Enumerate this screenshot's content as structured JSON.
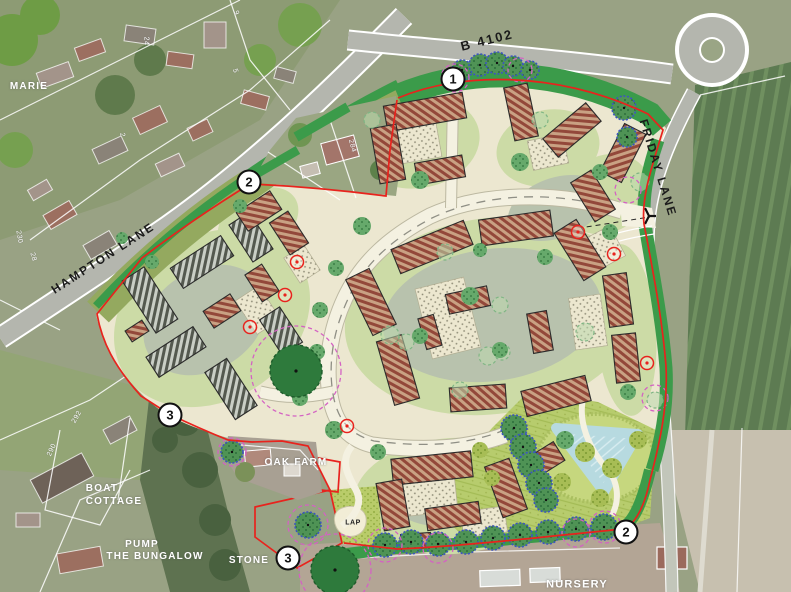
{
  "map_type": "residential development masterplan over aerial photograph",
  "colors": {
    "boundary_red": "#e8231d",
    "buffer_green": "#3b9b4a",
    "verge_olive": "#94a95f",
    "site_cream": "#ece7d0",
    "garden_light": "#ccdba6",
    "courtyard_sage": "#b8c2ad",
    "road_fill": "#f4f1e1",
    "road_dash": "#8f8f85",
    "roof_brown": "#93483a",
    "roof_brown_light": "#c9a183",
    "roof_gray": "#54594f",
    "roof_gray_light": "#c9cec5",
    "tree_green": "#66a96b",
    "tree_dark": "#2e7a3c",
    "tree_blue": "#3c55c0",
    "canopy_magenta": "#d462c3",
    "pond_blue": "#b7dae0",
    "openspace_green": "#b7cc6d",
    "openspace_tree": "#a7bd55",
    "aerial_road": "#b4b6ae",
    "aerial_field": "#5d7b52"
  },
  "labels": {
    "roads": [
      {
        "text": "B 4102",
        "x": 487,
        "y": 40,
        "rot": -14,
        "size": 13
      },
      {
        "text": "HAMPTON LANE",
        "x": 103,
        "y": 258,
        "rot": -33,
        "size": 12
      },
      {
        "text": "FRIDAY LANE",
        "x": 658,
        "y": 168,
        "rot": 73,
        "size": 12
      }
    ],
    "places": [
      {
        "text": "MARIE",
        "x": 29,
        "y": 87,
        "size": 10
      },
      {
        "text": "BOAT",
        "x": 102,
        "y": 489,
        "size": 10
      },
      {
        "text": "COTTAGE",
        "x": 114,
        "y": 502,
        "size": 10
      },
      {
        "text": "PUMP",
        "x": 142,
        "y": 545,
        "size": 10
      },
      {
        "text": "THE BUNGALOW",
        "x": 155,
        "y": 557,
        "size": 10
      },
      {
        "text": "STONE",
        "x": 249,
        "y": 561,
        "size": 10
      },
      {
        "text": "OAK FARM",
        "x": 296,
        "y": 463,
        "size": 10
      },
      {
        "text": "NURSERY",
        "x": 577,
        "y": 585,
        "size": 11
      }
    ],
    "plot_numbers": [
      {
        "text": "24",
        "x": 146,
        "y": 41,
        "rot": 90,
        "size": 7
      },
      {
        "text": "9",
        "x": 236,
        "y": 13,
        "rot": 70,
        "size": 7
      },
      {
        "text": "5",
        "x": 235,
        "y": 71,
        "rot": 75,
        "size": 7
      },
      {
        "text": "2",
        "x": 122,
        "y": 135,
        "rot": 80,
        "size": 7
      },
      {
        "text": "284",
        "x": 352,
        "y": 146,
        "rot": 75,
        "size": 7
      },
      {
        "text": "292",
        "x": 77,
        "y": 417,
        "rot": -60,
        "size": 7
      },
      {
        "text": "290",
        "x": 52,
        "y": 450,
        "rot": -65,
        "size": 7
      },
      {
        "text": "230",
        "x": 19,
        "y": 237,
        "rot": 80,
        "size": 7
      },
      {
        "text": "28",
        "x": 33,
        "y": 257,
        "rot": 75,
        "size": 7
      }
    ],
    "lap": {
      "text": "LAP",
      "x": 353,
      "y": 523,
      "size": 7
    }
  },
  "markers": [
    {
      "n": "1",
      "x": 453,
      "y": 79
    },
    {
      "n": "2",
      "x": 249,
      "y": 182
    },
    {
      "n": "3",
      "x": 170,
      "y": 415
    },
    {
      "n": "3",
      "x": 288,
      "y": 558
    },
    {
      "n": "2",
      "x": 626,
      "y": 532
    }
  ],
  "plan": {
    "buildings": [
      [
        425,
        112,
        80,
        26,
        -10,
        "b"
      ],
      [
        388,
        154,
        26,
        56,
        -10,
        "b"
      ],
      [
        440,
        170,
        48,
        22,
        -10,
        "b"
      ],
      [
        521,
        112,
        24,
        54,
        -12,
        "b"
      ],
      [
        572,
        130,
        56,
        24,
        -40,
        "b"
      ],
      [
        623,
        153,
        54,
        24,
        -63,
        "b"
      ],
      [
        593,
        196,
        24,
        46,
        -32,
        "b"
      ],
      [
        432,
        247,
        78,
        26,
        -22,
        "b"
      ],
      [
        516,
        228,
        72,
        26,
        -8,
        "b"
      ],
      [
        580,
        250,
        26,
        56,
        -32,
        "b"
      ],
      [
        618,
        300,
        24,
        52,
        -8,
        "b"
      ],
      [
        626,
        358,
        24,
        48,
        -6,
        "b"
      ],
      [
        556,
        396,
        66,
        26,
        -14,
        "b"
      ],
      [
        478,
        398,
        56,
        24,
        -4,
        "b"
      ],
      [
        398,
        370,
        26,
        66,
        -16,
        "b"
      ],
      [
        371,
        302,
        26,
        62,
        -26,
        "b"
      ],
      [
        468,
        300,
        42,
        20,
        -12,
        "b"
      ],
      [
        540,
        332,
        20,
        40,
        -10,
        "b"
      ],
      [
        430,
        332,
        16,
        32,
        -16,
        "b"
      ],
      [
        150,
        300,
        26,
        62,
        -33,
        "g"
      ],
      [
        202,
        262,
        60,
        24,
        -33,
        "g"
      ],
      [
        251,
        237,
        24,
        44,
        -33,
        "g"
      ],
      [
        176,
        352,
        56,
        24,
        -33,
        "g"
      ],
      [
        231,
        389,
        26,
        56,
        -33,
        "g"
      ],
      [
        281,
        331,
        24,
        42,
        -33,
        "g"
      ],
      [
        222,
        311,
        32,
        20,
        -33,
        "b"
      ],
      [
        262,
        283,
        20,
        32,
        -33,
        "b"
      ],
      [
        137,
        331,
        20,
        13,
        -33,
        "b"
      ],
      [
        259,
        211,
        40,
        22,
        -33,
        "b"
      ],
      [
        289,
        233,
        22,
        38,
        -33,
        "b"
      ],
      [
        432,
        468,
        80,
        26,
        -6,
        "b"
      ],
      [
        393,
        505,
        26,
        48,
        -10,
        "b"
      ],
      [
        453,
        516,
        54,
        22,
        -8,
        "b"
      ],
      [
        506,
        488,
        26,
        54,
        -20,
        "b"
      ],
      [
        543,
        461,
        38,
        22,
        -32,
        "b"
      ],
      [
        416,
        541,
        30,
        15,
        -4,
        "b"
      ]
    ],
    "parking_courts": [
      [
        416,
        142,
        46,
        38,
        -10
      ],
      [
        548,
        152,
        36,
        30,
        -12
      ],
      [
        448,
        318,
        50,
        72,
        -14
      ],
      [
        600,
        250,
        40,
        34,
        -28
      ],
      [
        588,
        322,
        32,
        52,
        -8
      ],
      [
        428,
        494,
        56,
        40,
        -6
      ],
      [
        484,
        522,
        44,
        26,
        -8
      ],
      [
        258,
        310,
        28,
        40,
        -33
      ],
      [
        302,
        264,
        24,
        30,
        -33
      ]
    ],
    "garden_areas": [
      [
        418,
        142,
        62,
        46,
        -10
      ],
      [
        548,
        148,
        52,
        38,
        -12
      ],
      [
        606,
        194,
        46,
        38,
        -30
      ],
      [
        492,
        316,
        148,
        98,
        -8
      ],
      [
        212,
        318,
        104,
        82,
        -33
      ],
      [
        452,
        496,
        98,
        58,
        -4
      ],
      [
        626,
        330,
        30,
        86,
        -4
      ],
      [
        258,
        222,
        44,
        30,
        -33
      ]
    ],
    "courtyards": [
      [
        492,
        315,
        110,
        66,
        -8
      ],
      [
        205,
        320,
        66,
        50,
        -33
      ],
      [
        556,
        208,
        50,
        30,
        -20
      ],
      [
        448,
        492,
        58,
        34,
        -6
      ]
    ],
    "trees": {
      "street": [
        [
          362,
          226,
          9
        ],
        [
          336,
          268,
          8
        ],
        [
          320,
          310,
          8
        ],
        [
          317,
          352,
          8
        ],
        [
          334,
          430,
          9
        ],
        [
          378,
          452,
          8
        ],
        [
          470,
          296,
          9
        ],
        [
          420,
          336,
          8
        ],
        [
          500,
          350,
          8
        ],
        [
          545,
          257,
          8
        ],
        [
          480,
          250,
          7
        ],
        [
          610,
          232,
          8
        ],
        [
          628,
          392,
          8
        ],
        [
          565,
          440,
          9
        ],
        [
          300,
          398,
          8
        ],
        [
          420,
          180,
          9
        ],
        [
          520,
          162,
          9
        ],
        [
          600,
          172,
          8
        ],
        [
          240,
          206,
          7
        ],
        [
          152,
          262,
          7
        ],
        [
          122,
          238,
          6
        ]
      ],
      "blue": [
        [
          462,
          70,
          10
        ],
        [
          480,
          65,
          11
        ],
        [
          497,
          63,
          11
        ],
        [
          513,
          66,
          10
        ],
        [
          530,
          70,
          9
        ],
        [
          624,
          108,
          12
        ],
        [
          627,
          137,
          10
        ],
        [
          514,
          428,
          13
        ],
        [
          523,
          447,
          13
        ],
        [
          531,
          465,
          13
        ],
        [
          539,
          483,
          13
        ],
        [
          546,
          500,
          12
        ],
        [
          385,
          545,
          12
        ],
        [
          411,
          542,
          12
        ],
        [
          438,
          544,
          12
        ],
        [
          466,
          542,
          12
        ],
        [
          493,
          538,
          12
        ],
        [
          520,
          535,
          12
        ],
        [
          548,
          532,
          12
        ],
        [
          576,
          529,
          12
        ],
        [
          604,
          527,
          13
        ],
        [
          308,
          525,
          13
        ],
        [
          232,
          452,
          11
        ]
      ],
      "dark": [
        [
          296,
          371,
          26
        ],
        [
          335,
          570,
          24
        ]
      ],
      "red": [
        [
          297,
          262
        ],
        [
          285,
          295
        ],
        [
          250,
          327
        ],
        [
          578,
          232
        ],
        [
          614,
          254
        ],
        [
          647,
          363
        ],
        [
          347,
          426
        ]
      ],
      "pale": [
        [
          390,
          335,
          9
        ],
        [
          406,
          342,
          8
        ],
        [
          488,
          356,
          9
        ],
        [
          502,
          352,
          8
        ],
        [
          445,
          252,
          8
        ],
        [
          585,
          332,
          9
        ],
        [
          500,
          305,
          8
        ],
        [
          460,
          390,
          8
        ],
        [
          540,
          120,
          8
        ],
        [
          640,
          182,
          9
        ],
        [
          655,
          400,
          8
        ],
        [
          372,
          120,
          8
        ]
      ],
      "olive": [
        [
          585,
          452,
          10
        ],
        [
          612,
          468,
          10
        ],
        [
          638,
          440,
          9
        ],
        [
          600,
          498,
          9
        ],
        [
          562,
          482,
          9
        ],
        [
          480,
          450,
          8
        ],
        [
          492,
          478,
          8
        ]
      ],
      "canopies": [
        [
          455,
          78,
          14
        ],
        [
          520,
          70,
          12
        ],
        [
          628,
          190,
          13
        ],
        [
          296,
          371,
          45
        ],
        [
          335,
          570,
          36
        ],
        [
          308,
          525,
          20
        ],
        [
          385,
          545,
          17
        ],
        [
          605,
          527,
          16
        ],
        [
          655,
          398,
          13
        ],
        [
          438,
          548,
          15
        ],
        [
          232,
          452,
          14
        ],
        [
          576,
          533,
          14
        ]
      ]
    }
  }
}
